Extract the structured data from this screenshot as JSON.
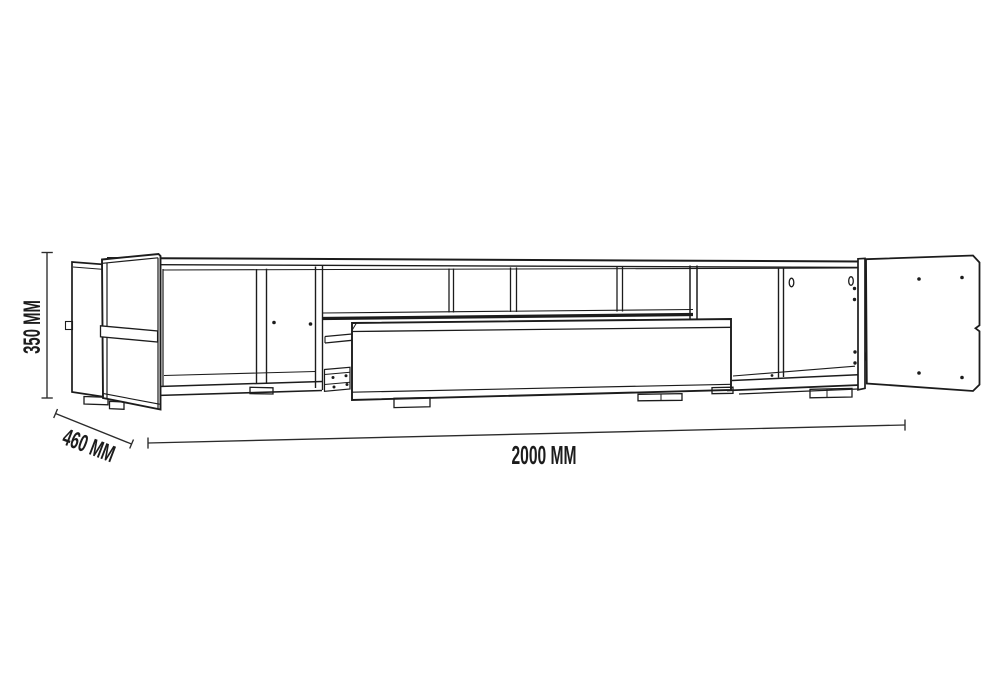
{
  "canvas": {
    "background": "#ffffff",
    "ink_color": "#1c1c1c",
    "dimension_color": "#2b2b2b"
  },
  "dimensions": {
    "height": {
      "label": "350 MM"
    },
    "depth": {
      "label": "460 MM"
    },
    "width": {
      "label": "2000 MM"
    }
  }
}
